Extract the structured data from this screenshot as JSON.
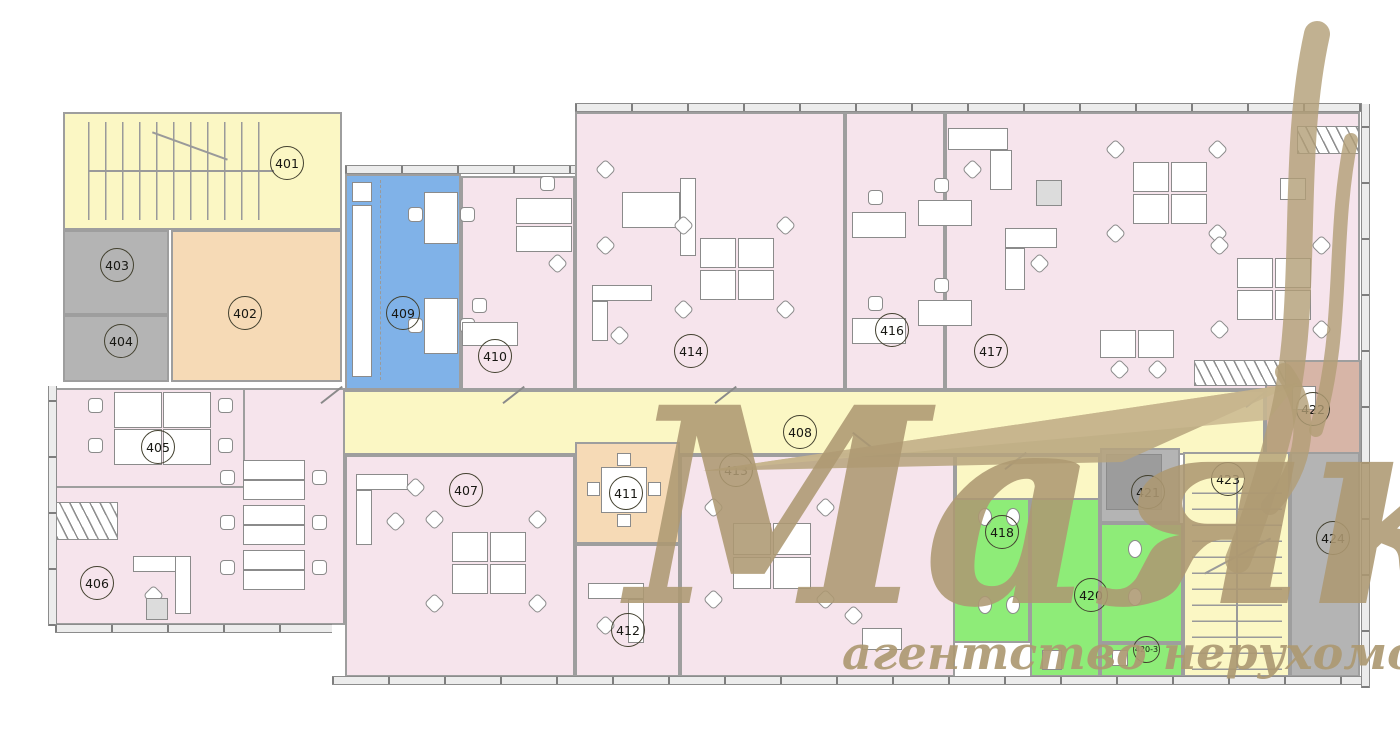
{
  "watermark": {
    "brand": "Маяк",
    "tagline": "агентство нерухомості",
    "color": "#ac9871"
  },
  "rooms": {
    "r401": "401",
    "r402": "402",
    "r403": "403",
    "r404": "404",
    "r405": "405",
    "r406": "406",
    "r407": "407",
    "r408": "408",
    "r409": "409",
    "r410": "410",
    "r411": "411",
    "r412": "412",
    "r413": "413",
    "r414": "414",
    "r416": "416",
    "r417": "417",
    "r418": "418",
    "r420": "420",
    "r420_3": "420-3",
    "r421": "421",
    "r422": "422",
    "r423": "423",
    "r424": "424"
  },
  "palette": {
    "office_pink": "#f6e4ec",
    "circulation_yellow": "#fbf7c4",
    "kitchen_blue": "#80b2e8",
    "meeting_orange": "#f6dab6",
    "service_gray": "#b4b4b4",
    "sanitary_green": "#8eec78",
    "lounge_brown": "#d7b5a7",
    "walls_gray": "#9e9e9e"
  }
}
